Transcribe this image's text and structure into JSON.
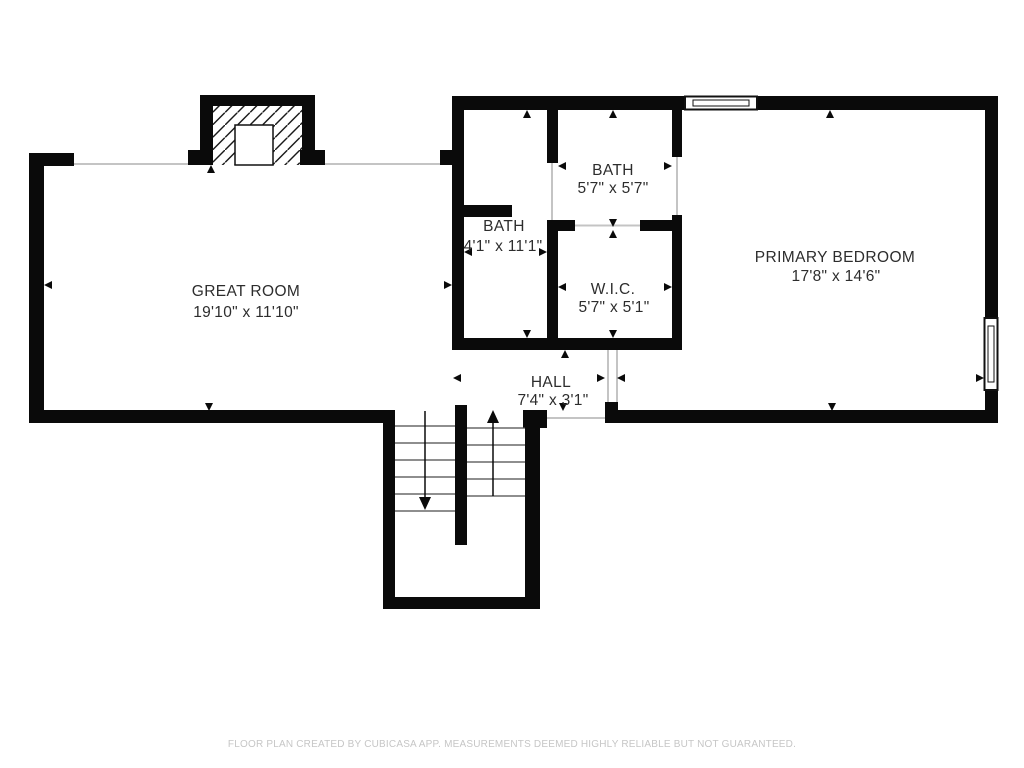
{
  "floor_plan": {
    "rooms": [
      {
        "name": "GREAT ROOM",
        "dimensions": "19'10\" x 11'10\""
      },
      {
        "name": "BATH",
        "dimensions": "4'1\" x 11'1\""
      },
      {
        "name": "BATH",
        "dimensions": "5'7\" x 5'7\""
      },
      {
        "name": "W.I.C.",
        "dimensions": "5'7\" x 5'1\""
      },
      {
        "name": "PRIMARY BEDROOM",
        "dimensions": "17'8\" x 14'6\""
      },
      {
        "name": "HALL",
        "dimensions": "7'4\" x 3'1\""
      }
    ],
    "footer": "FLOOR PLAN CREATED BY CUBICASA APP. MEASUREMENTS DEEMED HIGHLY RELIABLE BUT NOT GUARANTEED.",
    "colors": {
      "wall": "#0a0a0a",
      "text": "#2d2d2d",
      "opening_line": "#c4c4c4",
      "footer_text": "#c6c6c6",
      "background": "#ffffff"
    }
  }
}
